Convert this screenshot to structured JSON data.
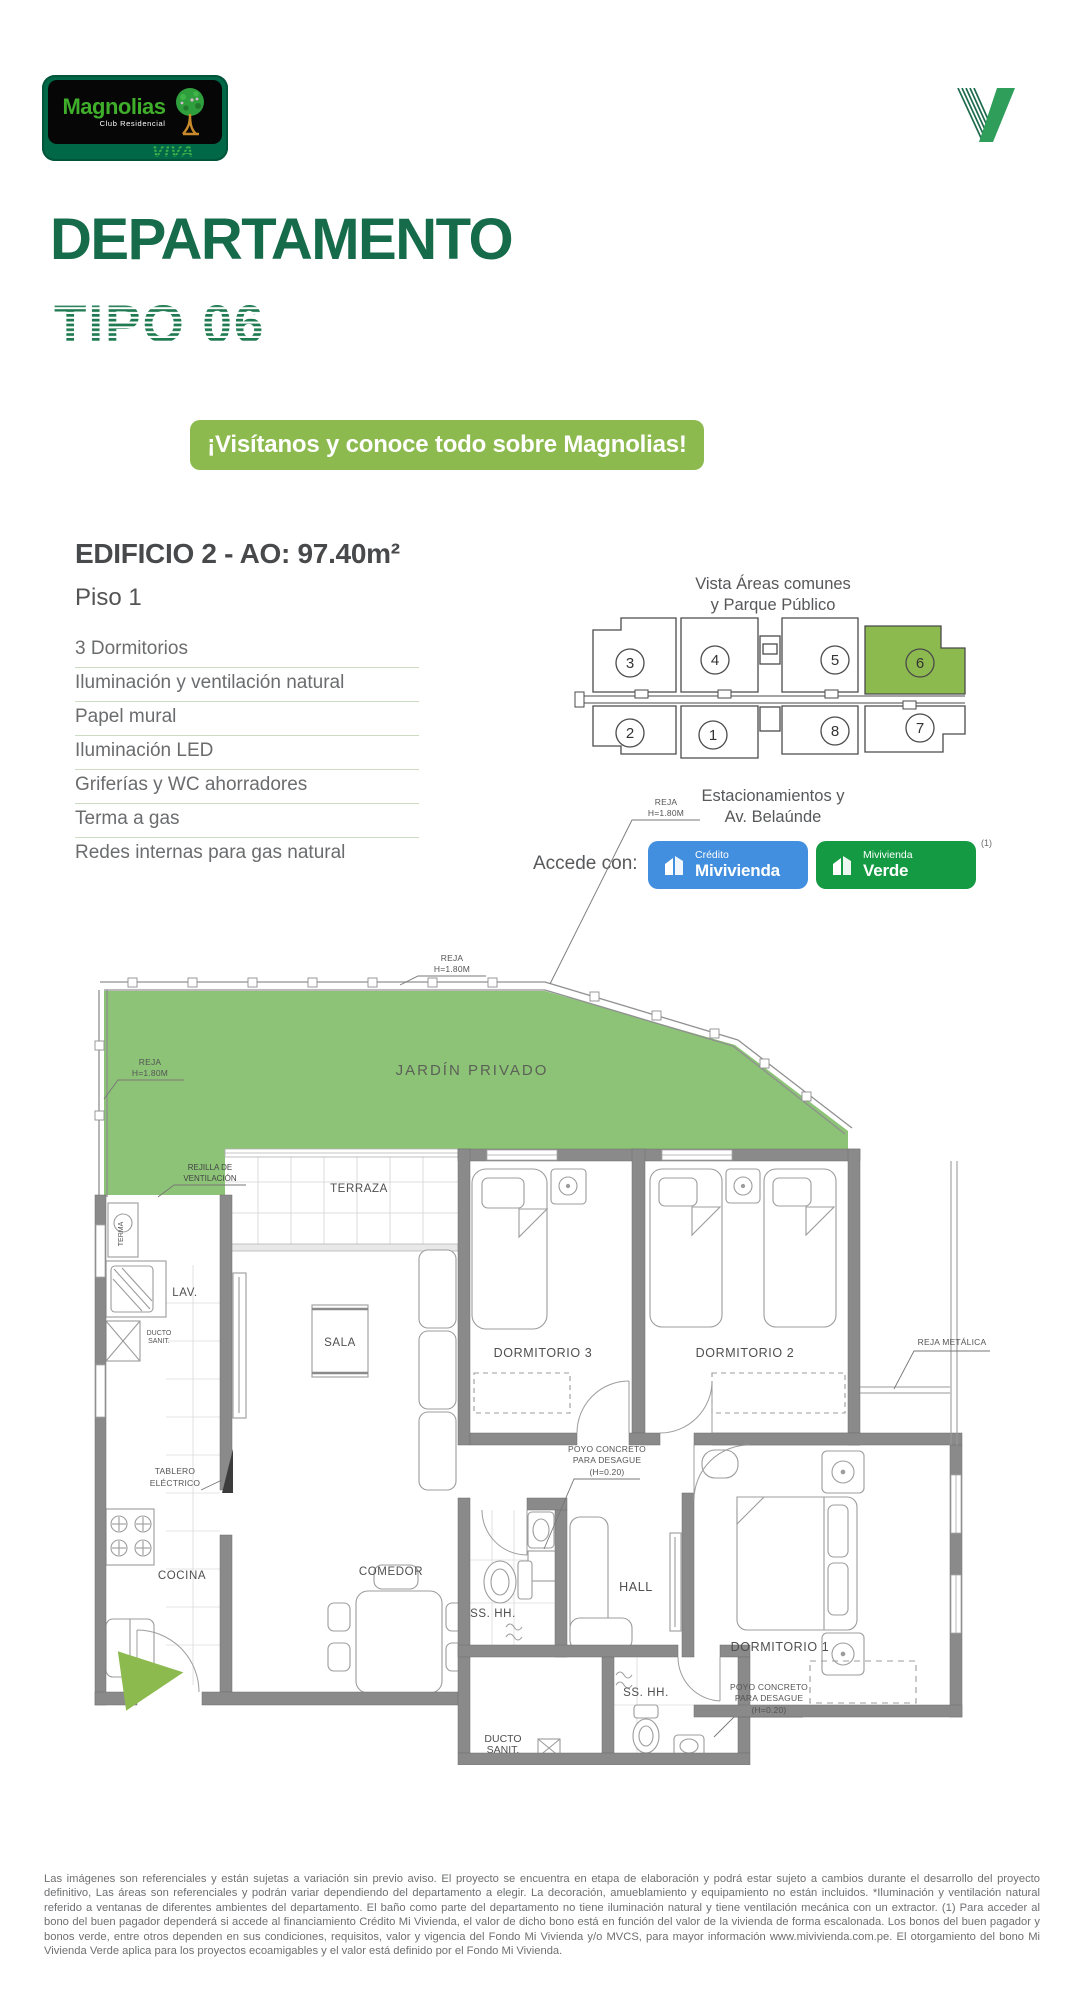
{
  "brand": {
    "name": "Magnolias",
    "tagline": "Club Residencial",
    "viva": "VIVA"
  },
  "title": {
    "line1": "DEPARTAMENTO",
    "line2": "TIPO 06"
  },
  "banner": {
    "text": "¡Visítanos y conoce todo sobre Magnolias!",
    "bg": "#8CBA4F"
  },
  "unit": {
    "heading": "EDIFICIO 2 - AO: 97.40m²",
    "floor": "Piso 1",
    "features": [
      "3 Dormitorios",
      "Iluminación y ventilación natural",
      "Papel mural",
      "Iluminación LED",
      "Griferías y WC ahorradores",
      "Terma a gas",
      "Redes internas para gas natural"
    ]
  },
  "miniplan": {
    "caption_top_1": "Vista Áreas comunes",
    "caption_top_2": "y Parque Público",
    "caption_bottom_1": "Estacionamientos y",
    "caption_bottom_2": "Av. Belaúnde",
    "units": [
      "3",
      "4",
      "5",
      "6",
      "2",
      "1",
      "8",
      "7"
    ],
    "highlighted_unit": "6",
    "highlight_color": "#8CBA4F"
  },
  "access": {
    "label": "Accede con:",
    "badge_blue": {
      "line1": "Crédito",
      "line2": "Mivivienda",
      "color": "#418FDE"
    },
    "badge_green": {
      "line1": "Mivivienda",
      "line2": "Verde",
      "color": "#149A43"
    },
    "note": "(1)"
  },
  "floorplan": {
    "garden_color": "#8CC377",
    "labels": {
      "jardin": "JARDÍN PRIVADO",
      "terraza": "TERRAZA",
      "sala": "SALA",
      "lav": "LAV.",
      "cocina": "COCINA",
      "comedor": "COMEDOR",
      "dorm3": "DORMITORIO 3",
      "dorm2": "DORMITORIO 2",
      "dorm1": "DORMITORIO 1",
      "hall": "HALL",
      "sshh": "SS. HH.",
      "ducto1": "DUCTO",
      "ducto2": "SANIT.",
      "terma": "TERMA"
    },
    "ann": {
      "reja": "REJA",
      "reja_h": "H=1.80M",
      "rejilla1": "REJILLA DE",
      "rejilla2": "VENTILACIÓN",
      "reja_metalica": "REJA METÁLICA",
      "tablero1": "TABLERO",
      "tablero2": "ELÉCTRICO",
      "poyo1": "POYO CONCRETO",
      "poyo2": "PARA DESAGUE",
      "poyo3": "(H=0.20)"
    }
  },
  "legal": "Las imágenes son referenciales y están sujetas a variación sin previo aviso. El proyecto se encuentra en etapa de elaboración y podrá estar sujeto a cambios durante el desarrollo del proyecto definitivo, Las áreas son referenciales y podrán variar dependiendo del departamento a elegir. La decoración, amueblamiento y equipamiento no están incluidos. *Iluminación y ventilación natural referido a ventanas de diferentes ambientes del departamento. El baño como parte del departamento no tiene iluminación natural y tiene ventilación mecánica con un extractor. (1) Para acceder al bono del buen pagador dependerá si accede al financiamiento Crédito Mi Vivienda, el valor de dicho bono está en función del valor de la vivienda de forma escalonada. Los bonos del buen pagador y bonos verde, entre otros dependen en sus condiciones, requisitos, valor y vigencia del Fondo Mi Vivienda y/o MVCS, para mayor información www.mivivienda.com.pe. El otorgamiento del bono Mi Vivienda Verde aplica para los proyectos ecoamigables y el valor está definido por el Fondo Mi Vivienda."
}
